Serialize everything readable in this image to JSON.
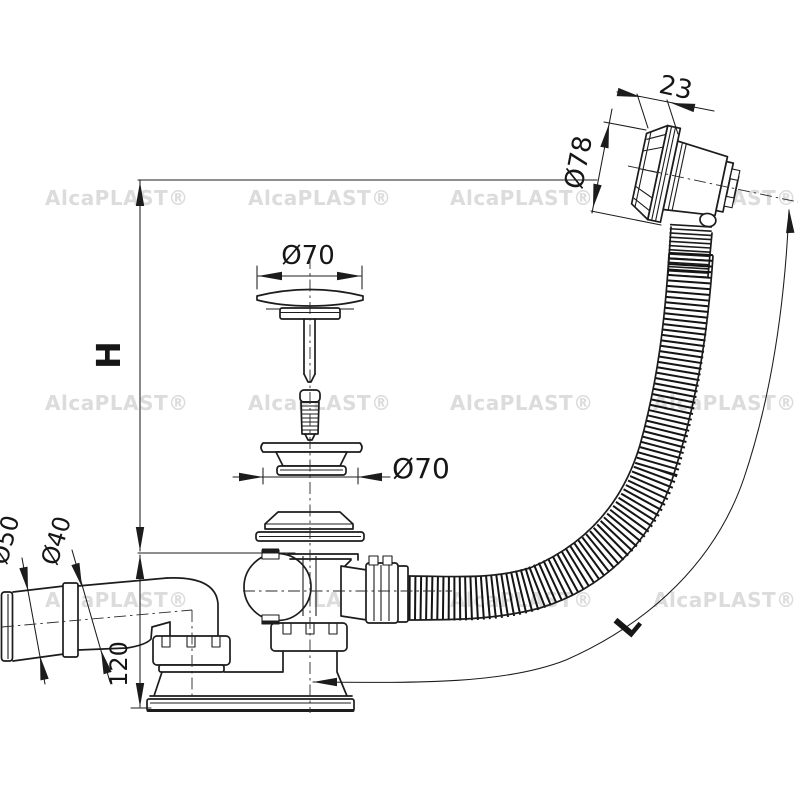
{
  "watermark": "AlcaPLAST®",
  "dimensions": {
    "width_23": "23",
    "dia_78": "Ø78",
    "dia_70_plug": "Ø70",
    "dia_70_seal": "Ø70",
    "dia_50": "Ø50",
    "dia_40": "Ø40",
    "height_120": "120",
    "height_h": "H",
    "length_l": "L"
  }
}
